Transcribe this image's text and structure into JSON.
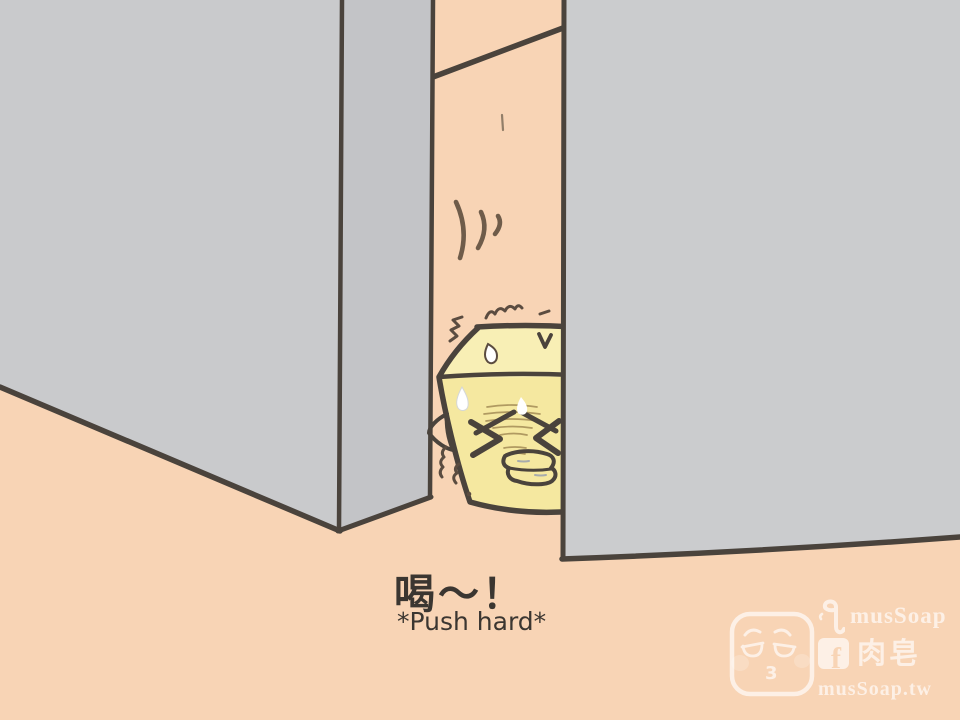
{
  "comic": {
    "sfx": "喝～！",
    "sfx_caption": "*Push hard*"
  },
  "watermark": {
    "brand": "musSoap",
    "brand_cjk": "肉皂",
    "website": "musSoap.tw",
    "badge_number": "3",
    "facebook_glyph": "f",
    "icons": [
      "soap-mascot-logo",
      "seahorse-logo-icon",
      "facebook-icon"
    ]
  },
  "colors": {
    "background": "#f8d4b5",
    "wall_front": "#c9cacc",
    "wall_side": "#c3c4c7",
    "wall_right": "#cbccce",
    "ink_outline": "#4a433c",
    "soap_body": "#f5e8a0",
    "soap_top": "#f8efb5",
    "sfx_text": "#3b3631",
    "watermark": "#ffffff"
  }
}
